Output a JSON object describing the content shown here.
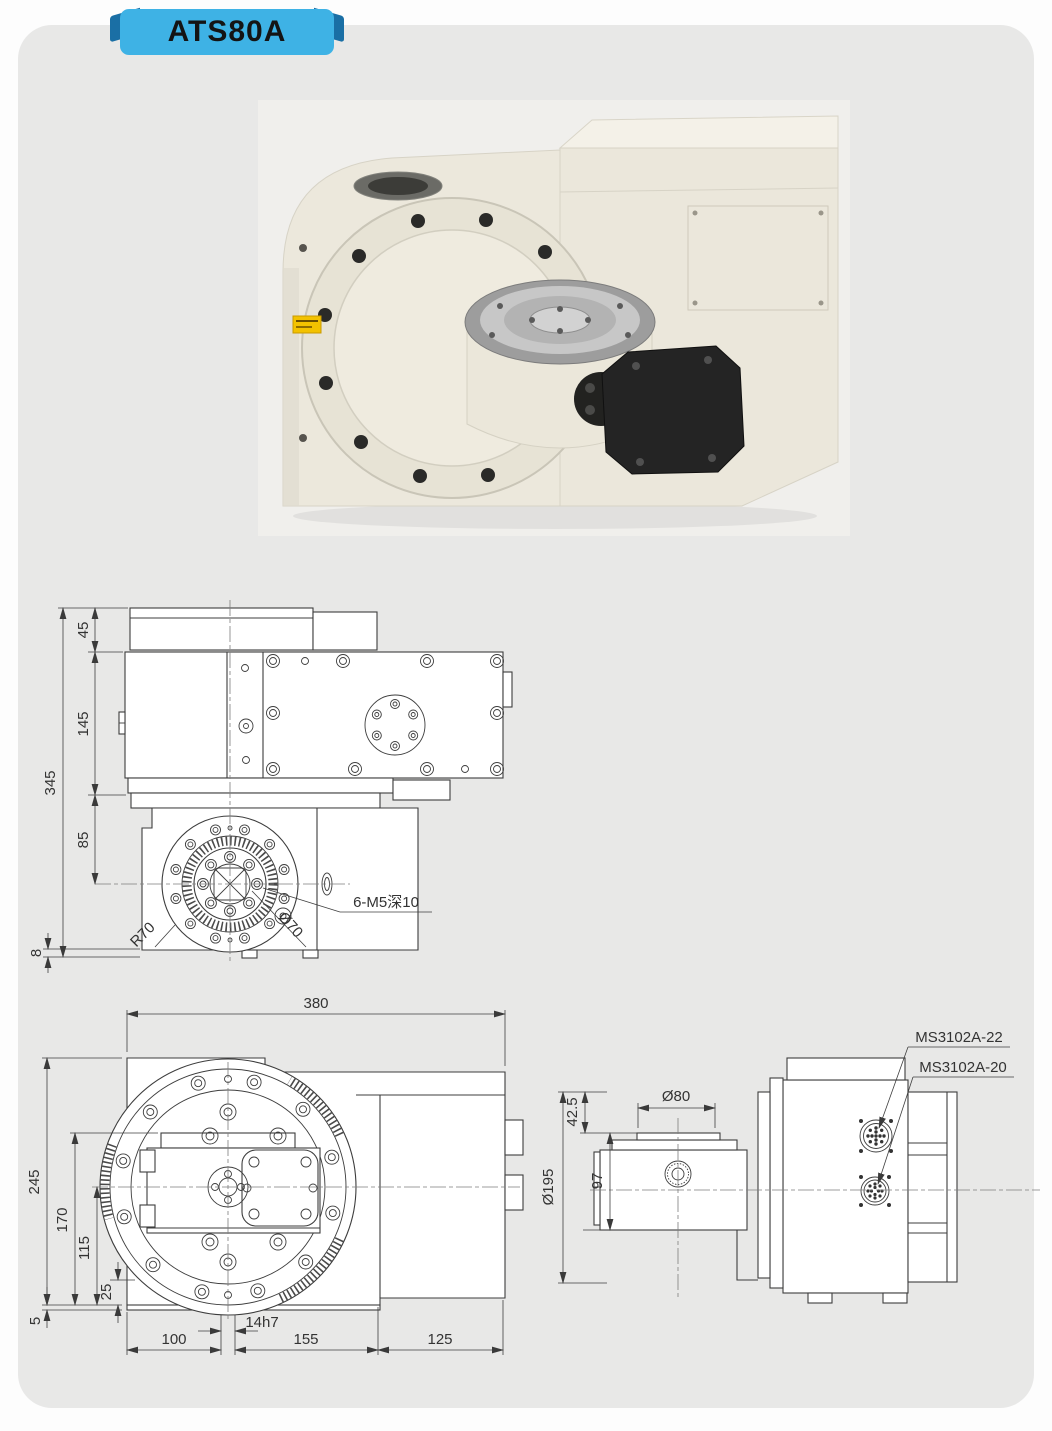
{
  "page": {
    "badge_label": "ATS80A",
    "colors": {
      "card_bg": "#e8e8e7",
      "badge_bg": "#3eb2e5",
      "badge_fold": "#1a6fa5",
      "line": "#3d3d3d",
      "machine_ivory": "#ece8dc",
      "warning_yellow": "#f3c200"
    }
  },
  "views": {
    "side": {
      "dims": {
        "overall_height": "345",
        "top_cover": "45",
        "body": "145",
        "flange_center": "85",
        "base": "8"
      },
      "labels": {
        "tap_holes": "6-M5深10",
        "flange_radius": "R70",
        "bolt_circle": "Ø70"
      }
    },
    "front": {
      "dims": {
        "overall_width": "380",
        "overall_height": "245",
        "h170": "170",
        "h115": "115",
        "h25": "25",
        "h5": "5",
        "w100": "100",
        "keyway": "14h7",
        "w155": "155",
        "w125": "125"
      }
    },
    "right": {
      "dims": {
        "flange_dia": "Ø195",
        "top_offset": "42.5",
        "table_dia": "Ø80",
        "table_width": "97"
      },
      "labels": {
        "connector_upper": "MS3102A-22",
        "connector_lower": "MS3102A-20"
      }
    }
  }
}
